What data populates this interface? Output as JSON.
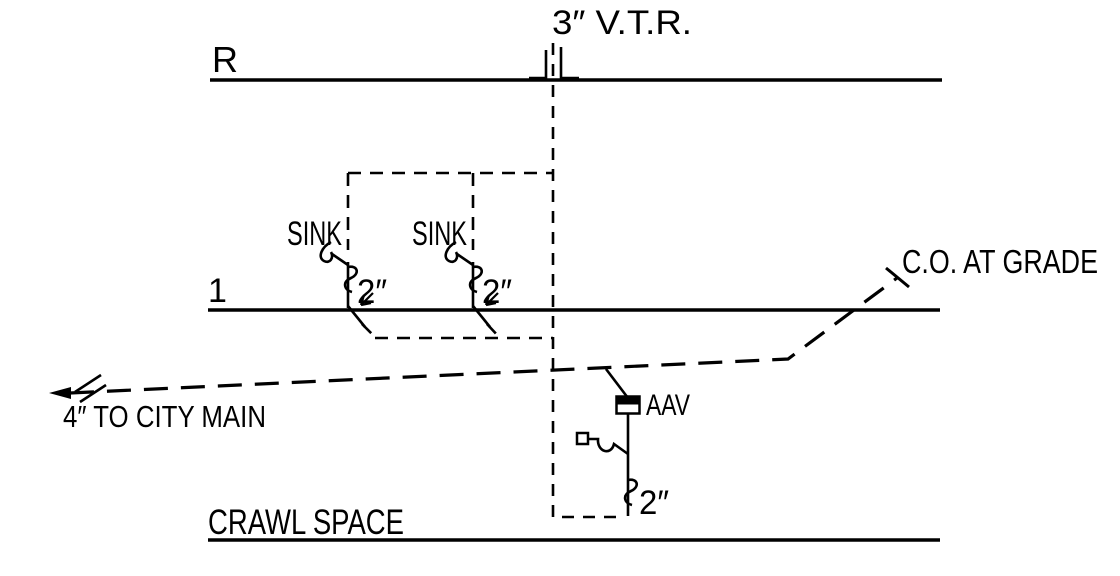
{
  "canvas": {
    "background": "#ffffff",
    "ink": "#000000"
  },
  "labels": {
    "vtr": "3″ V.T.R.",
    "roof": "R",
    "floor": "1",
    "sink1": {
      "name": "SINK",
      "size": "2″"
    },
    "sink2": {
      "name": "SINK",
      "size": "2″"
    },
    "cleanout": "C.O. AT GRADE",
    "city_main": "4″ TO CITY MAIN",
    "aav": {
      "label": "AAV",
      "size": "2″"
    },
    "crawl_space": "CRAWL SPACE"
  }
}
